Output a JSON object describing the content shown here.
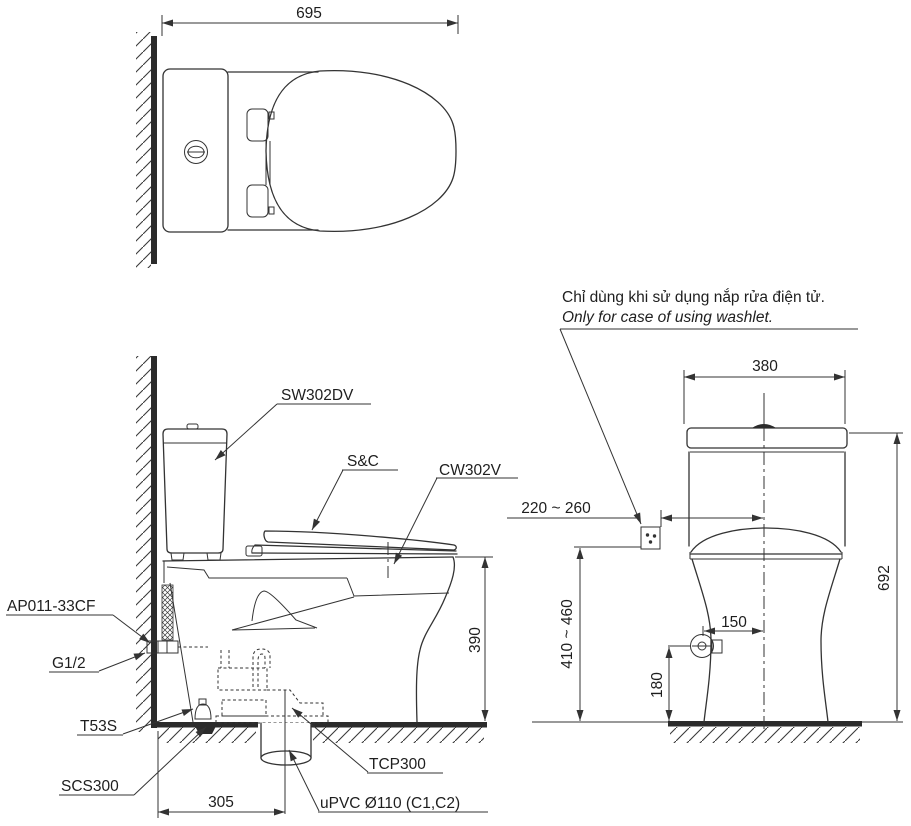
{
  "top_view": {
    "dim_width": "695"
  },
  "side_view": {
    "labels": {
      "tank": "SW302DV",
      "seat_cover": "S&C",
      "bowl": "CW302V",
      "supply_hose": "AP011-33CF",
      "water_inlet": "G1/2",
      "stop_valve": "T53S",
      "floor_flange": "SCS300",
      "outlet_adapter": "TCP300",
      "drain_pipe": "uPVC Ø110 (C1,C2)"
    },
    "dims": {
      "rim_height": "390",
      "outlet_to_wall": "305"
    }
  },
  "front_view": {
    "note": {
      "vi": "Chỉ dùng khi sử dụng nắp rửa điện tử.",
      "en": "Only for case of using washlet."
    },
    "dims": {
      "tank_width": "380",
      "total_height": "692",
      "outlet_offset": "220 ~ 260",
      "outlet_height": "410 ~ 460",
      "valve_offset": "150",
      "valve_height": "180"
    }
  }
}
